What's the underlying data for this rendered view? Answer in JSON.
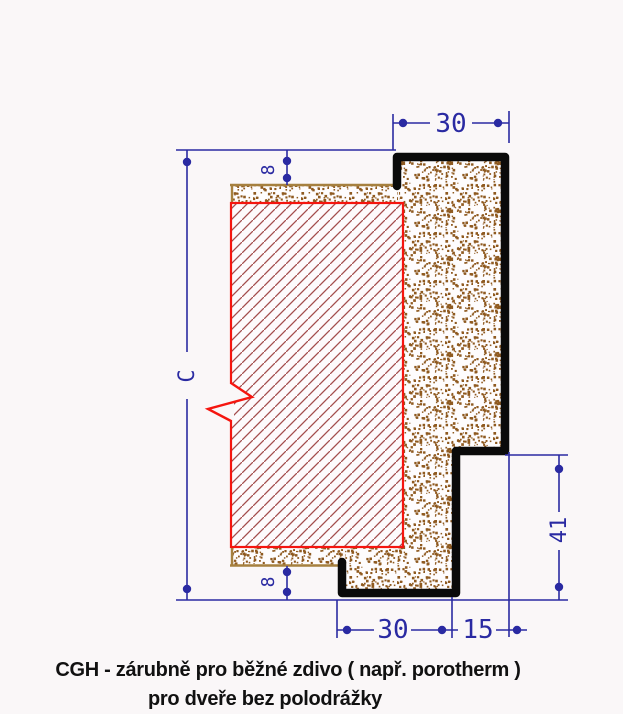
{
  "dimensions": {
    "top_width": "30",
    "top_plaster_offset": "8",
    "opening_height": "C",
    "frame_depth": "41",
    "bottom_width": "30",
    "bottom_lip": "15",
    "bottom_plaster_offset": "8"
  },
  "caption": {
    "line1": "CGH - zárubně pro běžné zdivo ( např. porotherm )",
    "line2": "pro dveře bez polodrážky"
  },
  "colors": {
    "dimension_blue": "#2a2aa2",
    "frame_black": "#0a0a0a",
    "masonry_red": "#f5150f",
    "hatch_red": "#a34d4d",
    "mortar_brown": "#8f5a20",
    "mortar_border_tan": "#a6803f",
    "caption_black": "#111111",
    "background": "#faf7f8"
  }
}
